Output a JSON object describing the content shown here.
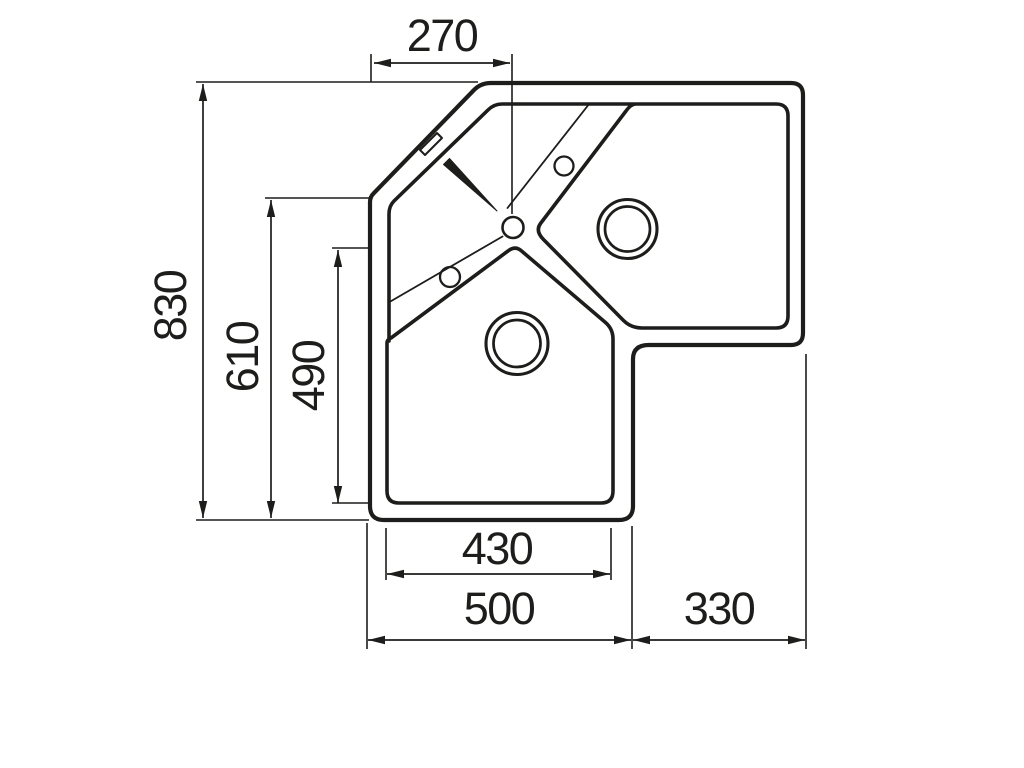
{
  "drawing": {
    "type": "corner-sink-top-view-technical-drawing",
    "background_color": "#ffffff",
    "line_color": "#1d1d1b",
    "dimensions_mm": {
      "corner_edge_to_drain": {
        "label": "270",
        "orientation": "horizontal",
        "position": "top"
      },
      "overall_depth": {
        "label": "830",
        "orientation": "vertical",
        "position": "left-outer"
      },
      "left_edge_depth": {
        "label": "610",
        "orientation": "vertical",
        "position": "left-middle"
      },
      "main_bowl_depth": {
        "label": "490",
        "orientation": "vertical",
        "position": "left-inner"
      },
      "main_bowl_width": {
        "label": "430",
        "orientation": "horizontal",
        "position": "bottom-inner"
      },
      "bottom_overall_width": {
        "label": "500",
        "orientation": "horizontal",
        "position": "bottom-outer-left"
      },
      "right_wing_width": {
        "label": "330",
        "orientation": "horizontal",
        "position": "bottom-outer-right"
      }
    },
    "features": [
      "outer-outline-with-corner-chamfer",
      "inner-rim-edge",
      "right-bowl",
      "bottom-bowl",
      "right-bowl-drain",
      "bottom-bowl-drain",
      "center-drain-hole",
      "tap-hole-upper",
      "tap-hole-lower",
      "overflow-slot",
      "drainer-groove-lines"
    ]
  }
}
